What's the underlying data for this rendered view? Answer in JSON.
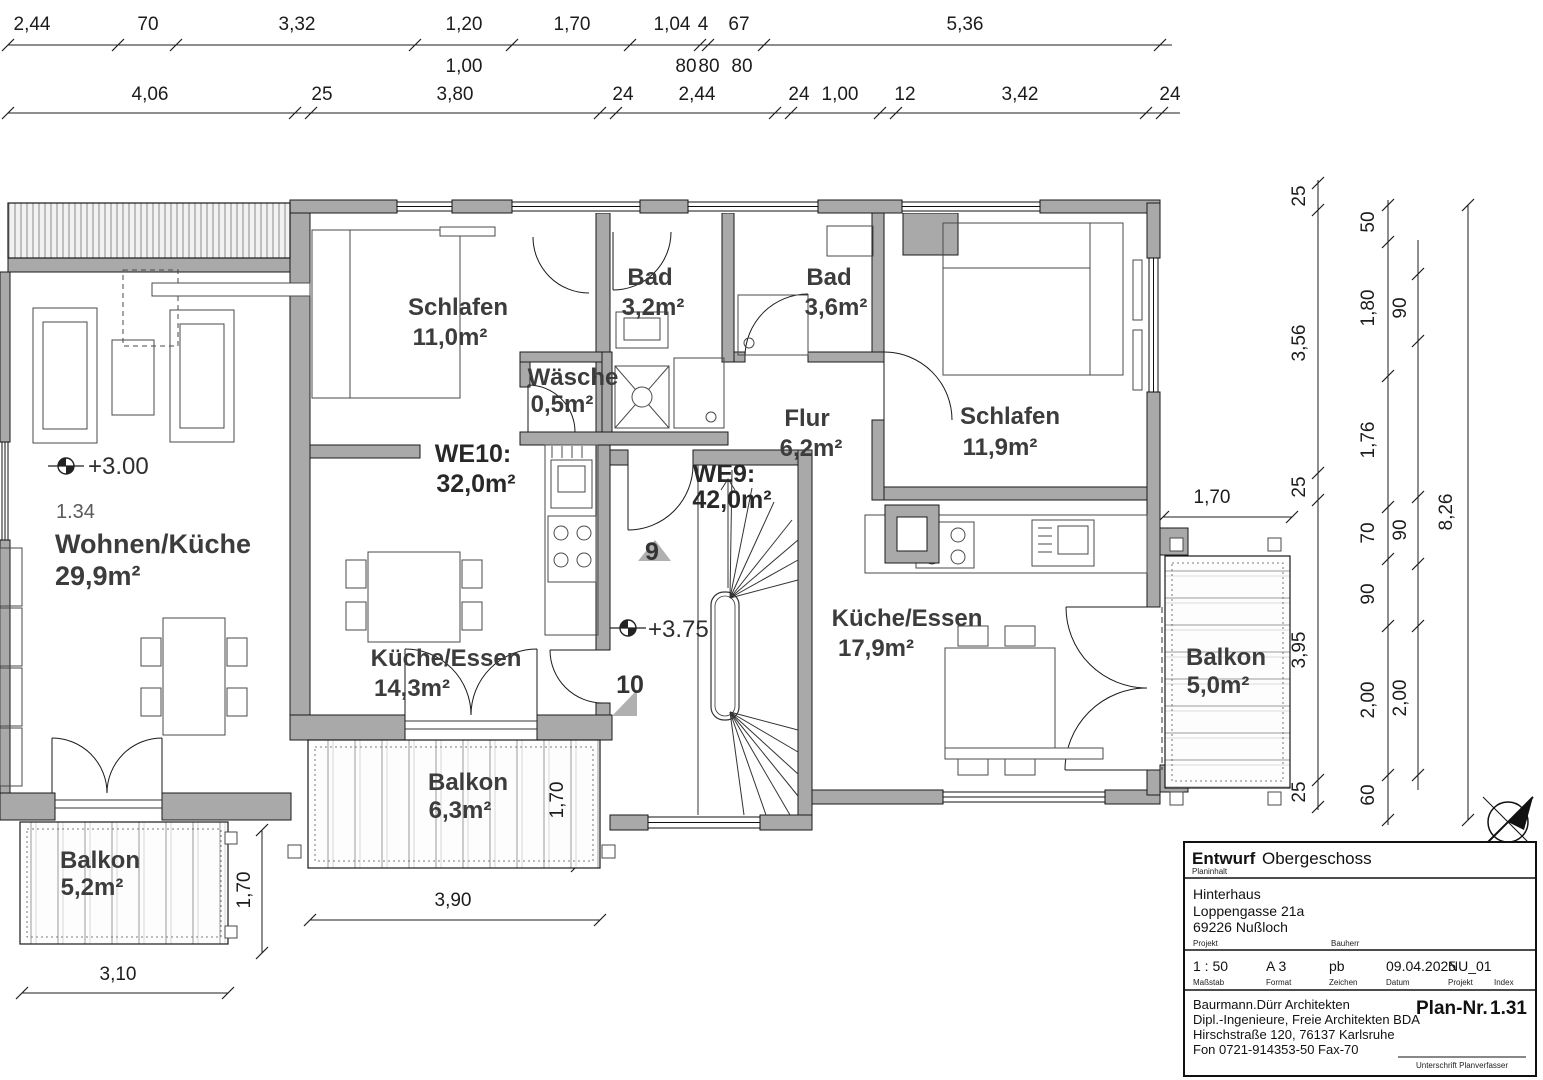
{
  "dims": {
    "top_row1": [
      "2,44",
      "70",
      "3,32",
      "1,20",
      "1,70",
      "1,04",
      "4",
      "67",
      "5,36"
    ],
    "top_row1_sub": [
      "1,00",
      "80",
      "80",
      "80"
    ],
    "top_row2": [
      "4,06",
      "25",
      "3,80",
      "24",
      "2,44",
      "24",
      "1,00",
      "12",
      "3,42",
      "24"
    ],
    "right_chain_inner": [
      "25",
      "3,56",
      "25",
      "3,95",
      "25"
    ],
    "right_chain_mid": [
      "50",
      "1,80",
      "1,76",
      "70",
      "90",
      "2,00",
      "60"
    ],
    "right_chain_windows": [
      "90",
      "90",
      "2,00"
    ],
    "right_total": "8,26",
    "balkon_right_width": "1,70",
    "balkon_mid_width": "3,90",
    "balkon_mid_depth": "1,70",
    "balkon_left_width": "3,10",
    "balkon_left_depth": "1,70"
  },
  "levels": {
    "main": "+3.00"
  },
  "stair": {
    "num_upper": "9",
    "num_lower": "10",
    "level": "+3.75"
  },
  "rooms": {
    "wohnen": {
      "number": "1.34",
      "name": "Wohnen/Küche",
      "area": "29,9m²"
    },
    "schlafen_we10": {
      "name": "Schlafen",
      "area": "11,0m²"
    },
    "bad_we10": {
      "name": "Bad",
      "area": "3,2m²"
    },
    "waesche": {
      "name": "Wäsche",
      "area": "0,5m²"
    },
    "we10": {
      "name": "WE10:",
      "area": "32,0m²"
    },
    "kueche_we10": {
      "name": "Küche/Essen",
      "area": "14,3m²"
    },
    "balkon_we10": {
      "name": "Balkon",
      "area": "6,3m²"
    },
    "bad_we9": {
      "name": "Bad",
      "area": "3,6m²"
    },
    "flur": {
      "name": "Flur",
      "area": "6,2m²"
    },
    "schlafen_we9": {
      "name": "Schlafen",
      "area": "11,9m²"
    },
    "we9": {
      "name": "WE9:",
      "area": "42,0m²"
    },
    "kueche_we9": {
      "name": "Küche/Essen",
      "area": "17,9m²"
    },
    "balkon_we9": {
      "name": "Balkon",
      "area": "5,0m²"
    },
    "balkon_left": {
      "name": "Balkon",
      "area": "5,2m²"
    }
  },
  "title_block": {
    "title_bold": "Entwurf",
    "title": "Obergeschoss",
    "planinhalt_label": "Planinhalt",
    "project_lines": [
      "Hinterhaus",
      "Loppengasse 21a",
      "69226 Nußloch"
    ],
    "projekt_label": "Projekt",
    "bauherr_label": "Bauherr",
    "fields": [
      {
        "value": "1 : 50",
        "label": "Maßstab"
      },
      {
        "value": "A 3",
        "label": "Format"
      },
      {
        "value": "pb",
        "label": "Zeichen"
      },
      {
        "value": "09.04.2025",
        "label": "Datum"
      },
      {
        "value": "NU_01",
        "label": "Projekt"
      },
      {
        "value": "",
        "label": "Index"
      }
    ],
    "firm_lines": [
      "Baurmann.Dürr Architekten",
      "Dipl.-Ingenieure, Freie Architekten BDA",
      "Hirschstraße 120, 76137 Karlsruhe",
      "Fon 0721-914353-50  Fax-70"
    ],
    "plan_nr_label": "Plan-Nr.",
    "plan_nr_value": "1.31",
    "signature_label": "Unterschrift Planverfasser"
  }
}
